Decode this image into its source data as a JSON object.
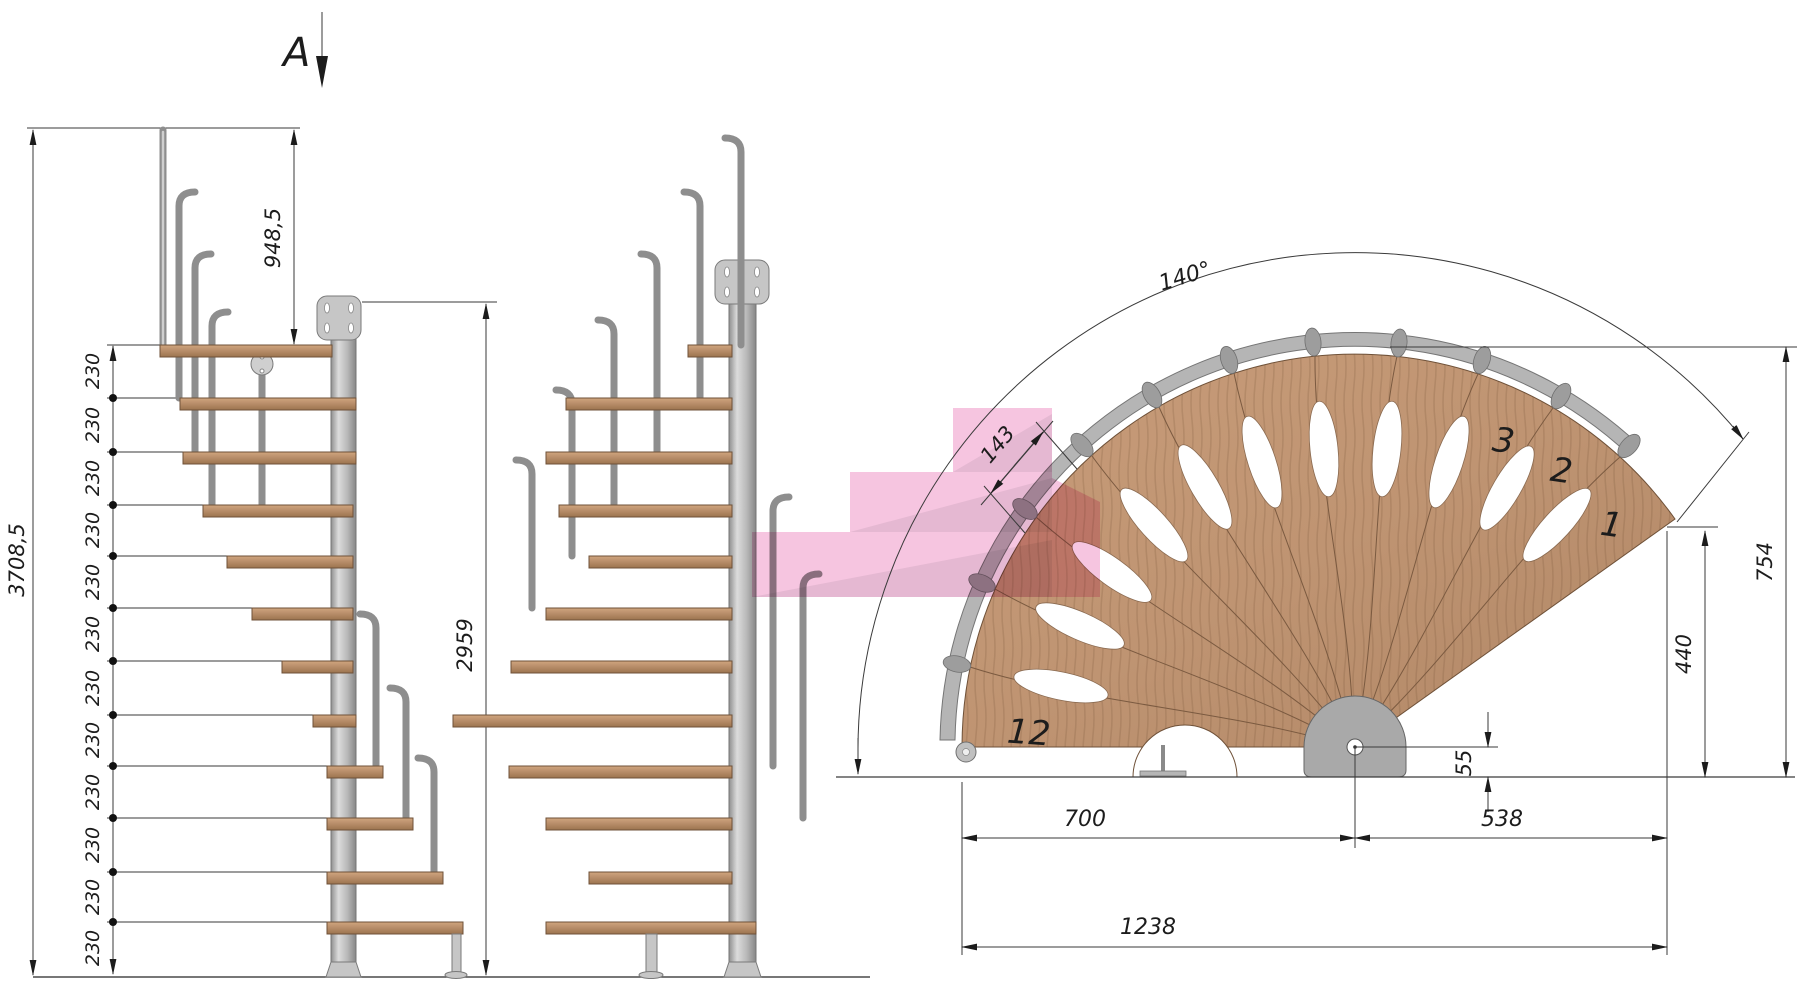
{
  "drawing": {
    "section_marker": "A",
    "elevation": {
      "total_height": "3708,5",
      "top_segment": "948,5",
      "rail_height": "2959",
      "riser_value": "230",
      "risers": [
        "230",
        "230",
        "230",
        "230",
        "230",
        "230",
        "230",
        "230",
        "230",
        "230",
        "230",
        "230"
      ]
    },
    "plan": {
      "rotation_angle": "140°",
      "tread_outer_width": "143",
      "outer_radius": "754",
      "tip_offset": "440",
      "pole_offset": "55",
      "left_span": "700",
      "right_span": "538",
      "total_span": "1238",
      "tread_numbers": {
        "t1": "1",
        "t2": "2",
        "t3": "3",
        "t12": "12"
      }
    },
    "colors": {
      "wood": "#bf9472",
      "wood_line": "#6f5138",
      "metal": "#bdbdbd",
      "metal_line": "#757575",
      "highlight_pink": "#f6c5e0",
      "dimension_line": "#3a3a3a"
    }
  }
}
